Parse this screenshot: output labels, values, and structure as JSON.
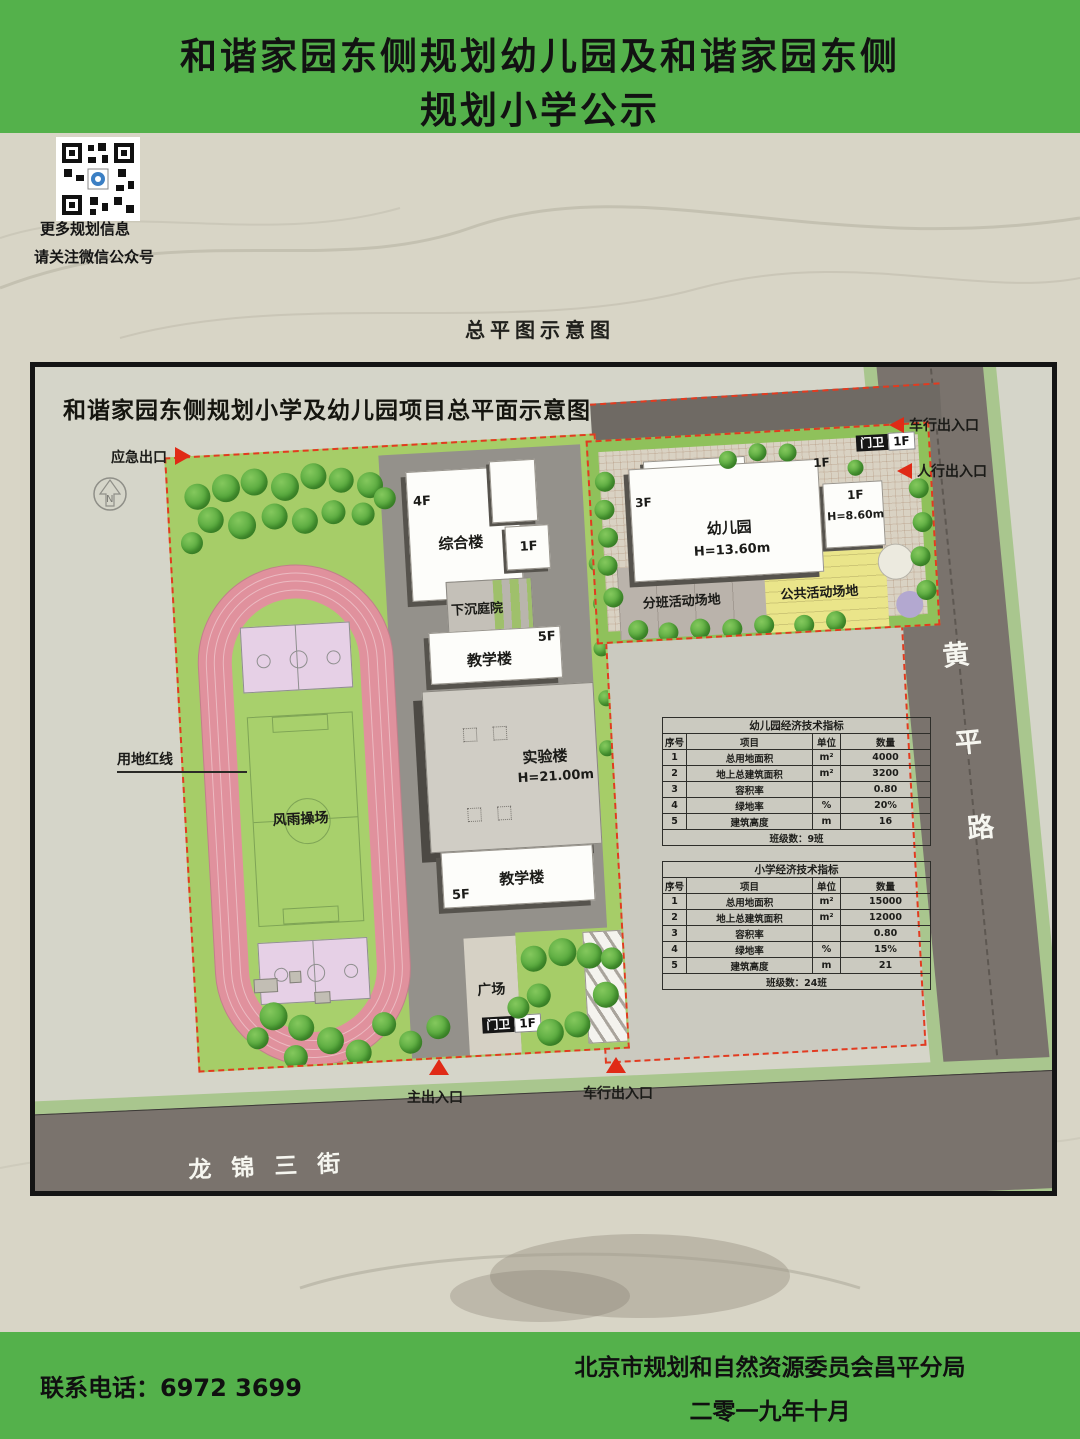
{
  "header": {
    "background_color": "#54b14b",
    "title_line1": "和谐家园东侧规划幼儿园及和谐家园东侧",
    "title_line2": "规划小学公示"
  },
  "qr_section": {
    "caption_line1": "更多规划信息",
    "caption_line2": "请关注微信公众号"
  },
  "section_label": "总平图示意图",
  "site_plan": {
    "title": "和谐家园东侧规划小学及幼儿园项目总平面示意图",
    "roads": {
      "east": {
        "name": "黄平路",
        "chars": [
          "黄",
          "平",
          "路"
        ]
      },
      "south": {
        "name": "龙锦三街"
      }
    },
    "school": {
      "emergency_exit": "应急出口",
      "site_red_line": "用地红线",
      "sports_ground": "风雨操场",
      "plaza": "广场",
      "buildings": {
        "complex": {
          "label": "综合楼",
          "floors": "4F"
        },
        "annex_floor": "1F",
        "sunken_courtyard": "下沉庭院",
        "teaching_north": {
          "label": "教学楼",
          "floors": "5F"
        },
        "laboratory": {
          "label": "实验楼",
          "height": "H=21.00m"
        },
        "teaching_south": {
          "label": "教学楼",
          "floors": "5F"
        },
        "gatehouse": {
          "label": "门卫",
          "floors": "1F"
        }
      },
      "entrances": {
        "main": "主出入口",
        "vehicle": "车行出入口"
      }
    },
    "kindergarten": {
      "main": {
        "label": "幼儿园",
        "height": "H=13.60m",
        "floors": "3F"
      },
      "west_wing": {
        "floors": "1F",
        "height": "H=5.40m"
      },
      "center_block_floors": "1F",
      "east_wing": {
        "floors": "1F",
        "height": "H=8.60m"
      },
      "gatehouse": {
        "label": "门卫",
        "floors": "1F"
      },
      "class_activity_area": "分班活动场地",
      "public_activity_area": "公共活动场地",
      "entrances": {
        "vehicle": "车行出入口",
        "pedestrian": "人行出入口"
      }
    },
    "tables": [
      {
        "title": "幼儿园经济技术指标",
        "headers": [
          "序号",
          "项目",
          "单位",
          "数量"
        ],
        "rows": [
          [
            "1",
            "总用地面积",
            "m²",
            "4000"
          ],
          [
            "2",
            "地上总建筑面积",
            "m²",
            "3200"
          ],
          [
            "3",
            "容积率",
            "",
            "0.80"
          ],
          [
            "4",
            "绿地率",
            "%",
            "20%"
          ],
          [
            "5",
            "建筑高度",
            "m",
            "16"
          ]
        ],
        "footer": "班级数：9班"
      },
      {
        "title": "小学经济技术指标",
        "headers": [
          "序号",
          "项目",
          "单位",
          "数量"
        ],
        "rows": [
          [
            "1",
            "总用地面积",
            "m²",
            "15000"
          ],
          [
            "2",
            "地上总建筑面积",
            "m²",
            "12000"
          ],
          [
            "3",
            "容积率",
            "",
            "0.80"
          ],
          [
            "4",
            "绿地率",
            "%",
            "15%"
          ],
          [
            "5",
            "建筑高度",
            "m",
            "21"
          ]
        ],
        "footer": "班级数：24班"
      }
    ],
    "colors": {
      "boundary_red": "#e23b20",
      "field_green": "#a6cd68",
      "track_pink": "#e0919d",
      "court_lavender": "#e6d0e6",
      "activity_yellow": "#eae58a",
      "road_gray": "#7a736d",
      "verge_green": "#a9c68e",
      "building_shadow": "#56534d"
    }
  },
  "footer": {
    "background_color": "#54b14b",
    "phone_label": "联系电话：",
    "phone_number": "6972 3699",
    "agency": "北京市规划和自然资源委员会昌平分局",
    "date": "二零一九年十月"
  }
}
